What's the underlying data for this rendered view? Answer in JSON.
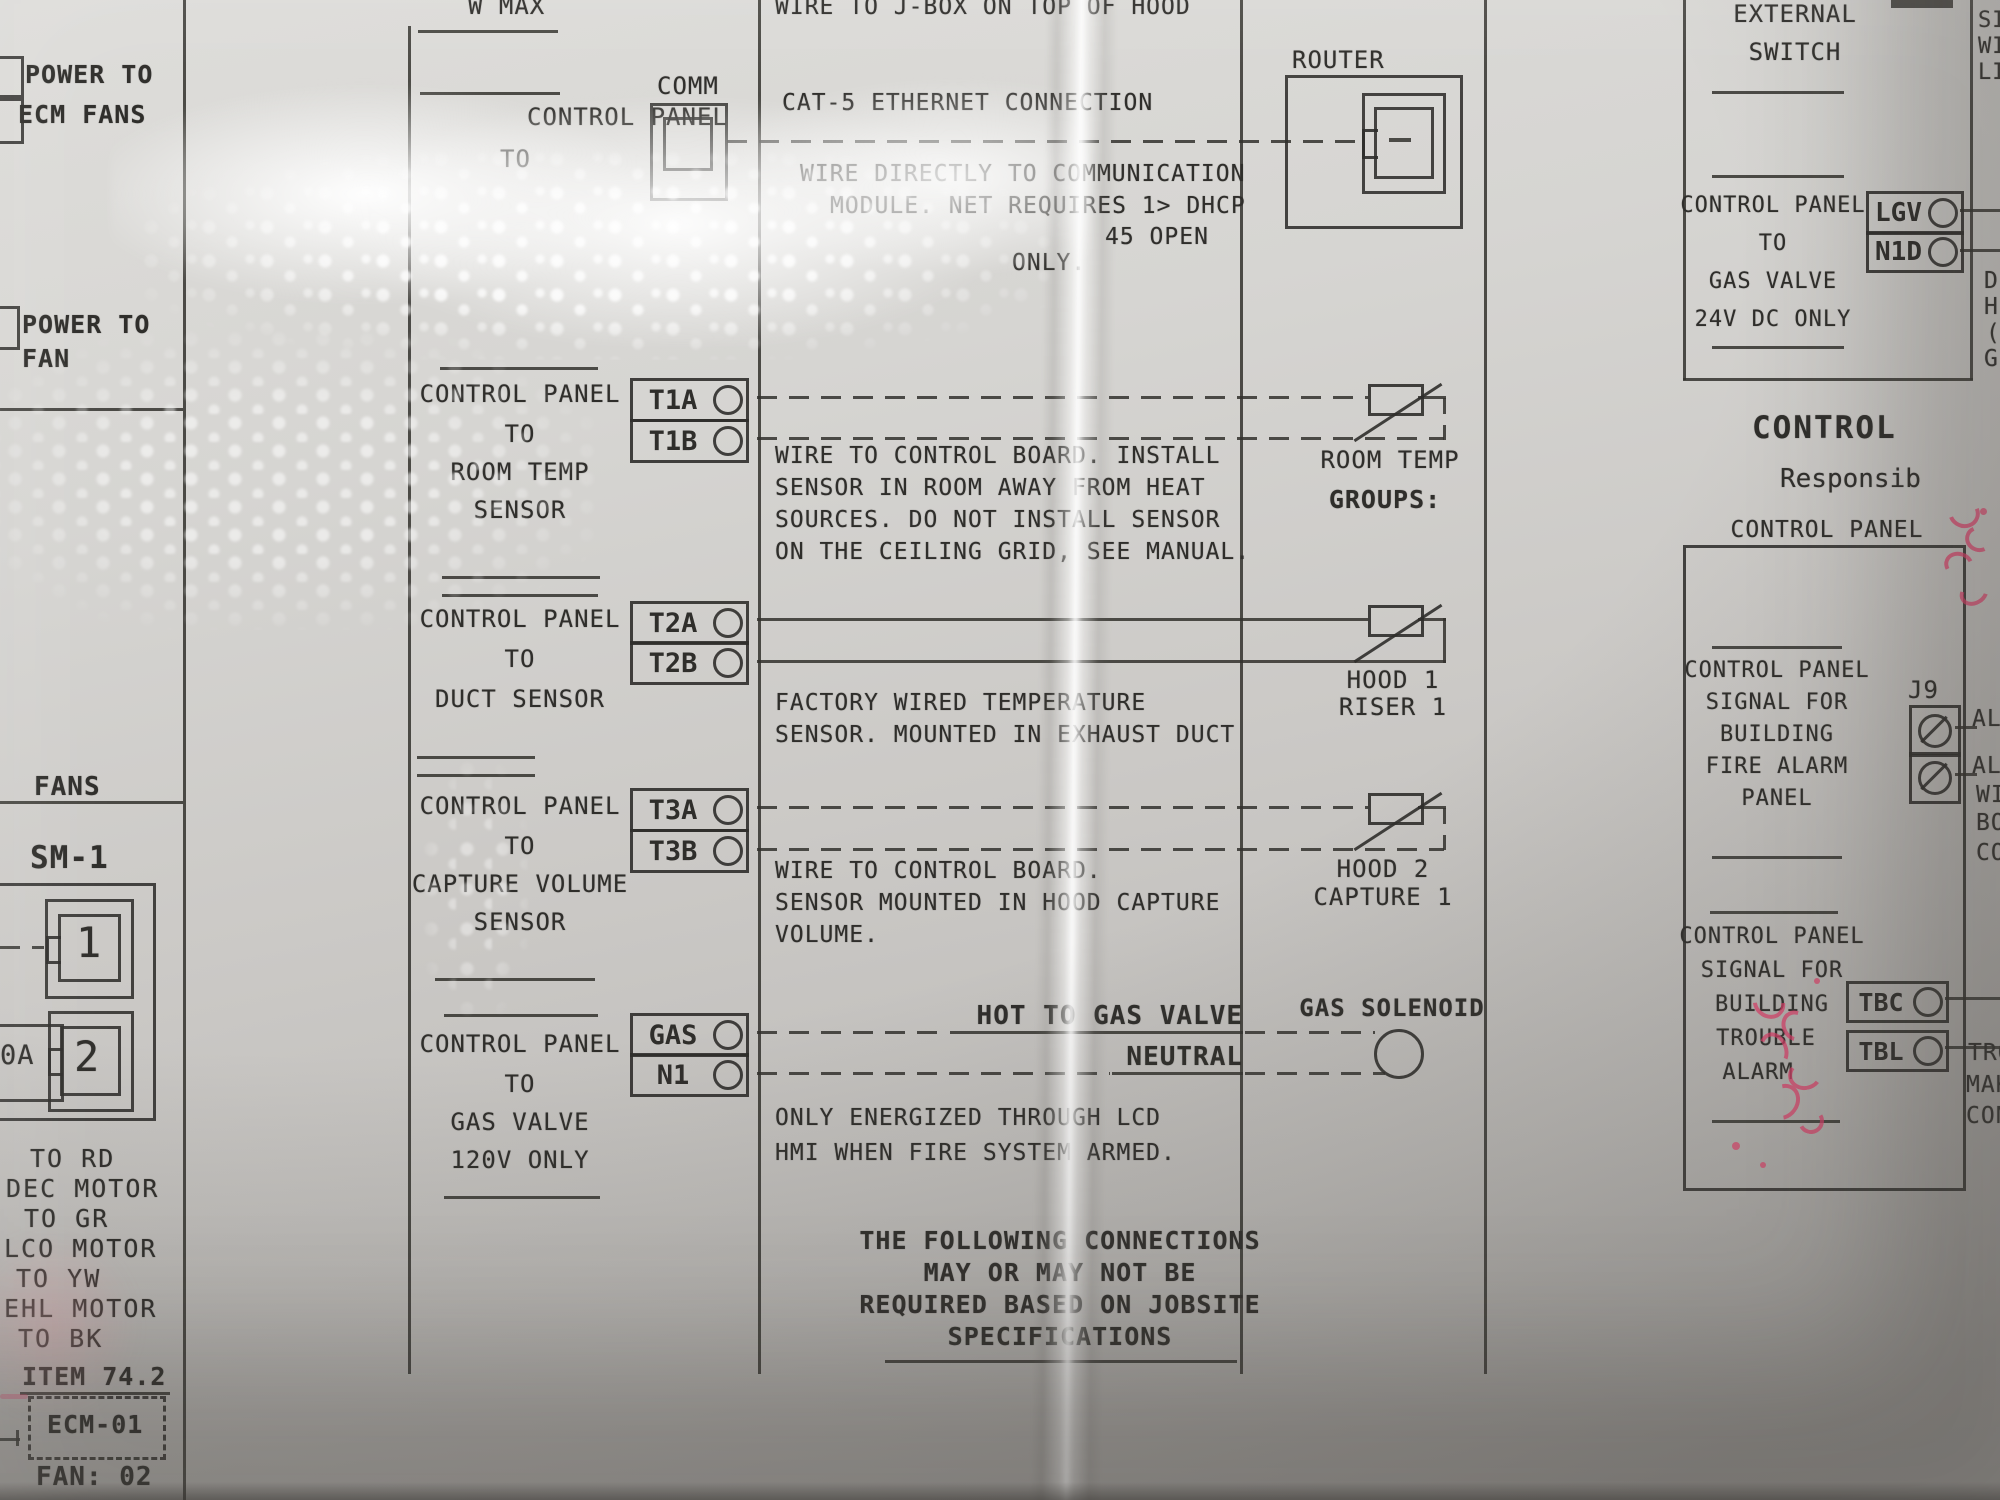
{
  "colors": {
    "paper": "#cfcdc9",
    "ink": "#2f2e2b",
    "marker": "#e63e6c"
  },
  "left_column": {
    "power_ecm_line1": "POWER TO",
    "power_ecm_line2": "ECM FANS",
    "power_fan_line1": "POWER TO",
    "power_fan_line2": "FAN",
    "fans_header": "FANS",
    "module_label": "SM-1",
    "jack1_label": "1",
    "jack2_label": "2",
    "plug_fragment": "0A",
    "wire_labels": [
      "TO RD",
      "DEC MOTOR",
      "TO GR",
      "LCO MOTOR",
      "TO YW",
      "EHL MOTOR",
      "TO BK"
    ],
    "item_label": "ITEM 74.2",
    "ecm_label": "ECM-01",
    "fan_id": "FAN: 02"
  },
  "comm_section": {
    "top_fragment": "W MAX",
    "line1": "CONTROL PANEL",
    "line2": "TO",
    "connector_label": "COMM"
  },
  "sections": {
    "room_temp": {
      "lines": [
        "CONTROL PANEL",
        "TO",
        "ROOM TEMP",
        "SENSOR"
      ],
      "t1": "T1A",
      "t2": "T1B"
    },
    "duct": {
      "lines": [
        "CONTROL PANEL",
        "TO",
        "DUCT SENSOR"
      ],
      "t1": "T2A",
      "t2": "T2B"
    },
    "capture": {
      "lines": [
        "CONTROL PANEL",
        "TO",
        "CAPTURE VOLUME",
        "SENSOR"
      ],
      "t1": "T3A",
      "t2": "T3B"
    },
    "gas": {
      "lines": [
        "CONTROL PANEL",
        "TO",
        "GAS VALVE",
        "120V ONLY"
      ],
      "t1": "GAS",
      "t2": "N1"
    }
  },
  "notes": {
    "jbox": "WIRE TO J-BOX ON TOP OF HOOD",
    "cat5": "CAT-5 ETHERNET CONNECTION",
    "comm_lines": [
      "WIRE DIRECTLY TO COMMUNICATION",
      "MODULE. NET REQUIRES 1> DHCP",
      "45 OPEN",
      "ONLY."
    ],
    "room_temp_lines": [
      "WIRE TO CONTROL BOARD. INSTALL",
      "SENSOR IN ROOM AWAY FROM HEAT",
      "SOURCES. DO NOT INSTALL SENSOR",
      "ON THE CEILING GRID, SEE MANUAL."
    ],
    "duct_lines": [
      "FACTORY WIRED TEMPERATURE",
      "SENSOR. MOUNTED IN EXHAUST DUCT"
    ],
    "capture_lines": [
      "WIRE TO CONTROL BOARD.",
      "SENSOR MOUNTED IN HOOD CAPTURE",
      "VOLUME."
    ],
    "gas_hot": "HOT TO GAS VALVE",
    "gas_neutral": "NEUTRAL",
    "gas_lines": [
      "ONLY ENERGIZED THROUGH LCD",
      "HMI WHEN FIRE SYSTEM ARMED."
    ],
    "footer_lines": [
      "THE FOLLOWING CONNECTIONS",
      "MAY OR MAY NOT BE",
      "REQUIRED BASED ON JOBSITE",
      "SPECIFICATIONS"
    ]
  },
  "targets": {
    "room_temp_group_line1": "ROOM TEMP",
    "room_temp_group_line2": "GROUPS:",
    "hood1_line1": "HOOD 1",
    "hood1_line2": "RISER 1",
    "hood2_line1": "HOOD 2",
    "hood2_line2": "CAPTURE 1",
    "gas_solenoid": "GAS SOLENOID",
    "router": "ROUTER"
  },
  "right_column": {
    "external_switch_line1": "EXTERNAL",
    "external_switch_line2": "SWITCH",
    "gas24": {
      "lines": [
        "CONTROL PANEL",
        "TO",
        "GAS VALVE",
        "24V DC ONLY"
      ],
      "t1": "LGV",
      "t2": "N1D"
    },
    "edge_top": [
      "SI",
      "WI",
      "LI"
    ],
    "edge_mid": [
      "D",
      "H",
      "(",
      "G"
    ],
    "control_heading": "CONTROL",
    "responsibility_fragment": "Responsib",
    "panel_header": "CONTROL PANEL",
    "fire": {
      "lines": [
        "CONTROL PANEL",
        "SIGNAL FOR",
        "BUILDING",
        "FIRE ALARM",
        "PANEL"
      ],
      "connector": "J9",
      "edge": [
        "AL1",
        "AL2",
        "WI",
        "BO",
        "CO"
      ]
    },
    "trouble": {
      "lines": [
        "CONTROL PANEL",
        "SIGNAL FOR",
        "BUILDING",
        "TROUBLE",
        "ALARM"
      ],
      "t1": "TBC",
      "t2": "TBL",
      "edge": [
        "TRO",
        "MAK",
        "CON"
      ]
    }
  }
}
